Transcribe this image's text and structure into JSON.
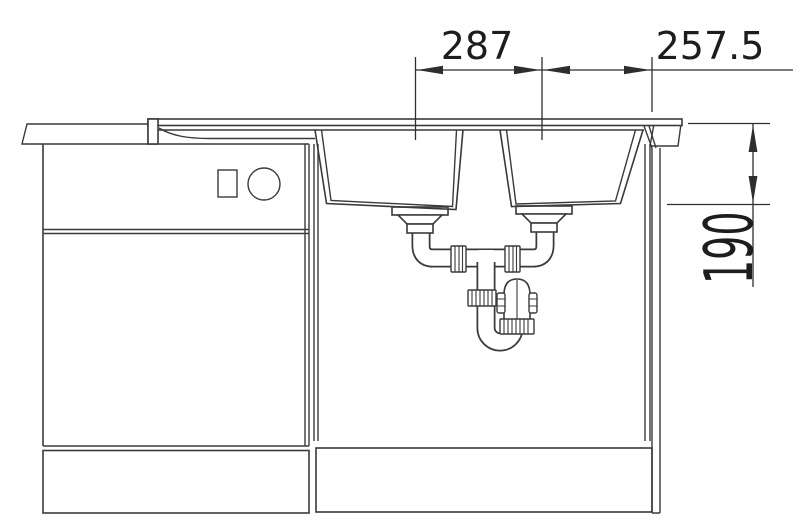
{
  "drawing": {
    "title": "sink-installation-technical-drawing",
    "dimensions": {
      "bowl_spacing": "287",
      "bowl_to_edge": "257.5",
      "bowl_depth": "190"
    },
    "colors": {
      "line": "#3a3a3a",
      "dimension_line": "#2e2e2e",
      "text": "#1d1d1d",
      "background": "#ffffff"
    }
  }
}
